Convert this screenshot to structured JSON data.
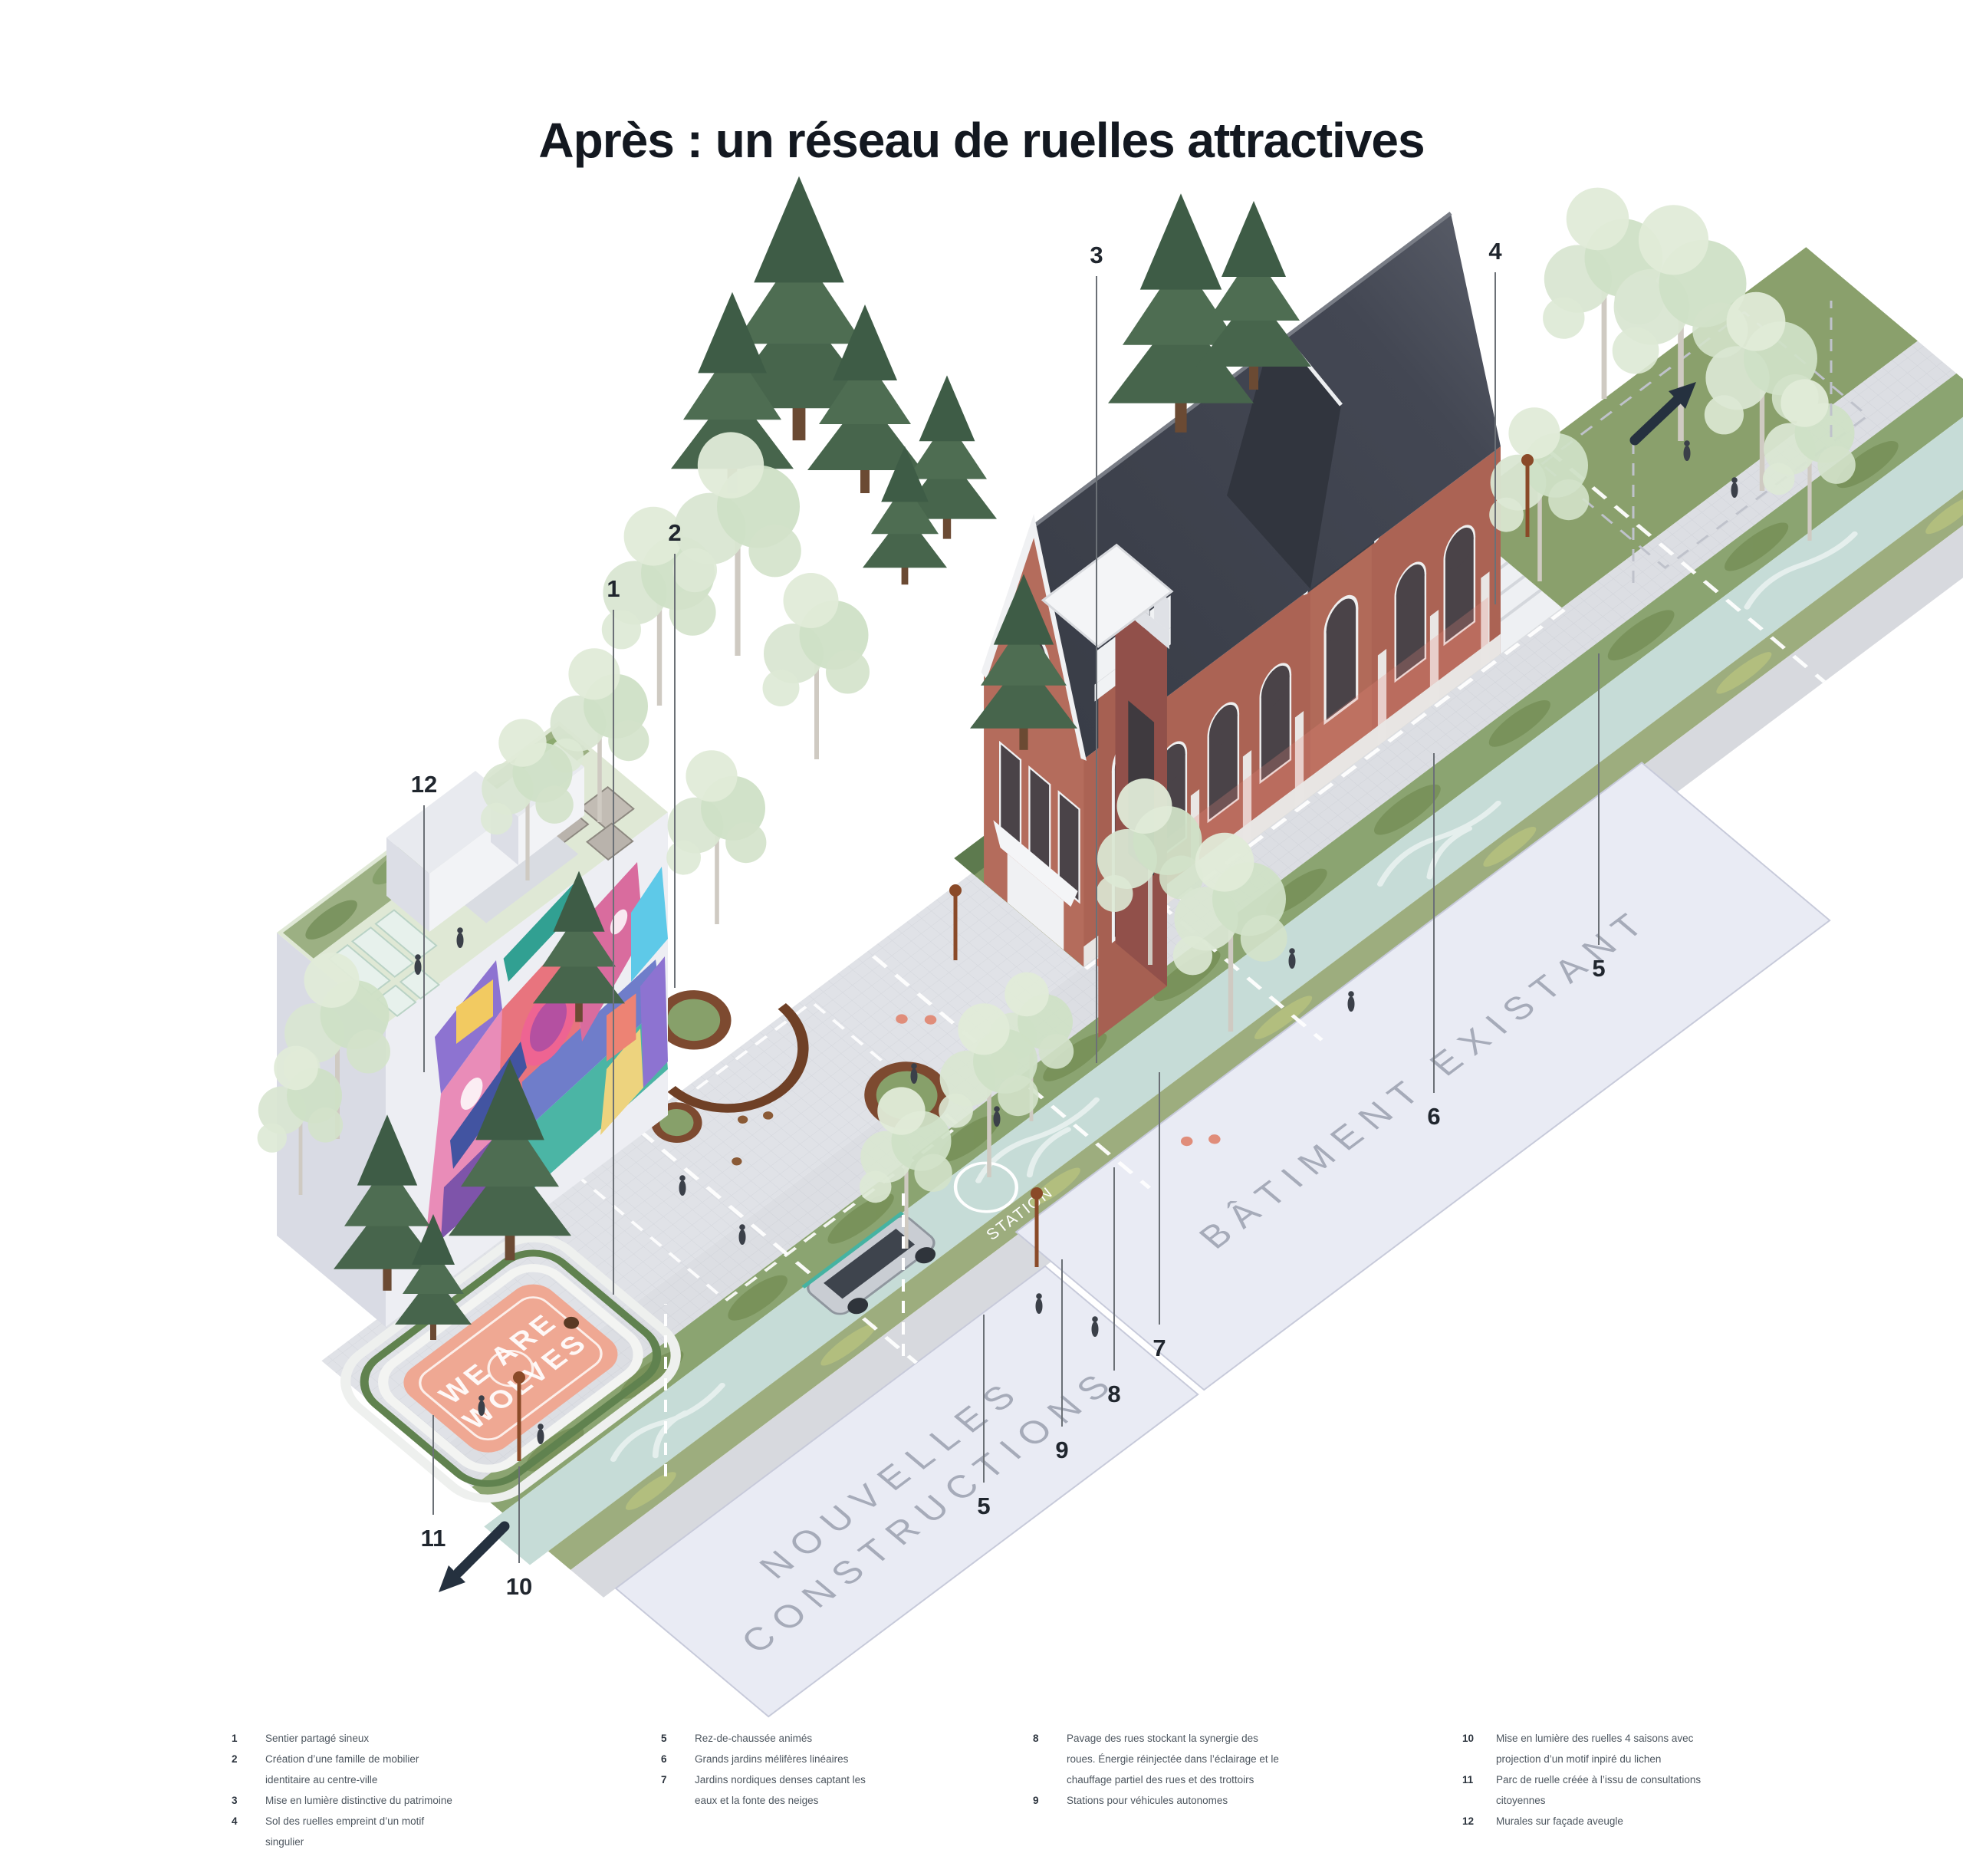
{
  "title": "Après : un réseau de ruelles attractives",
  "scene": {
    "ground_label_existing": "BÂTIMENT EXISTANT",
    "ground_label_new_line1": "NOUVELLES",
    "ground_label_new_line2": "CONSTRUCTIONS",
    "court_line1": "WE ARE",
    "court_line2": "WOLVES",
    "station_label": "STATION"
  },
  "callouts": [
    {
      "n": "1"
    },
    {
      "n": "2"
    },
    {
      "n": "3"
    },
    {
      "n": "4"
    },
    {
      "n": "5"
    },
    {
      "n": "6"
    },
    {
      "n": "7"
    },
    {
      "n": "8"
    },
    {
      "n": "9"
    },
    {
      "n": "10"
    },
    {
      "n": "11"
    },
    {
      "n": "12"
    },
    {
      "n": "5"
    }
  ],
  "legend": {
    "columns": [
      {
        "items": [
          {
            "n": "1",
            "lines": [
              "Sentier partagé sineux"
            ]
          },
          {
            "n": "2",
            "lines": [
              "Création d’une famille de mobilier",
              "identitaire au centre-ville"
            ]
          },
          {
            "n": "3",
            "lines": [
              "Mise en lumière distinctive du patrimoine"
            ]
          },
          {
            "n": "4",
            "lines": [
              "Sol des ruelles empreint d’un motif",
              "singulier"
            ]
          }
        ]
      },
      {
        "items": [
          {
            "n": "5",
            "lines": [
              "Rez-de-chaussée animés"
            ]
          },
          {
            "n": "6",
            "lines": [
              "Grands jardins mélifères linéaires"
            ]
          },
          {
            "n": "7",
            "lines": [
              "Jardins nordiques denses captant les",
              "eaux et la fonte des neiges"
            ]
          }
        ]
      },
      {
        "items": [
          {
            "n": "8",
            "lines": [
              "Pavage des rues stockant la synergie des",
              "roues. Énergie réinjectée dans l’éclairage et le",
              "chauffage partiel des rues et des trottoirs"
            ]
          },
          {
            "n": "9",
            "lines": [
              "Stations pour véhicules autonomes"
            ]
          }
        ]
      },
      {
        "items": [
          {
            "n": "10",
            "lines": [
              "Mise en lumière des ruelles 4 saisons avec",
              "projection d’un motif inpiré du lichen"
            ]
          },
          {
            "n": "11",
            "lines": [
              "Parc de ruelle créée à l’issu de consultations",
              "citoyennes"
            ]
          },
          {
            "n": "12",
            "lines": [
              "Murales sur façade aveugle"
            ]
          }
        ]
      }
    ]
  },
  "colors": {
    "ink": "#131820",
    "legend_text": "#4d565f",
    "leader": "#6b7076",
    "arrow": "#25313f",
    "plane_lavender": "#e9ebf4",
    "plane_label": "#a6abb9",
    "path_teal": "#c6dcd7",
    "garden_green": "#8ba471",
    "brick": "#ad6355",
    "roof": "#3d414b",
    "court_salmon": "#efa893",
    "mural_pink": "#e989b6",
    "mural_purple": "#8a6fd0",
    "mural_teal": "#45b3a2"
  }
}
